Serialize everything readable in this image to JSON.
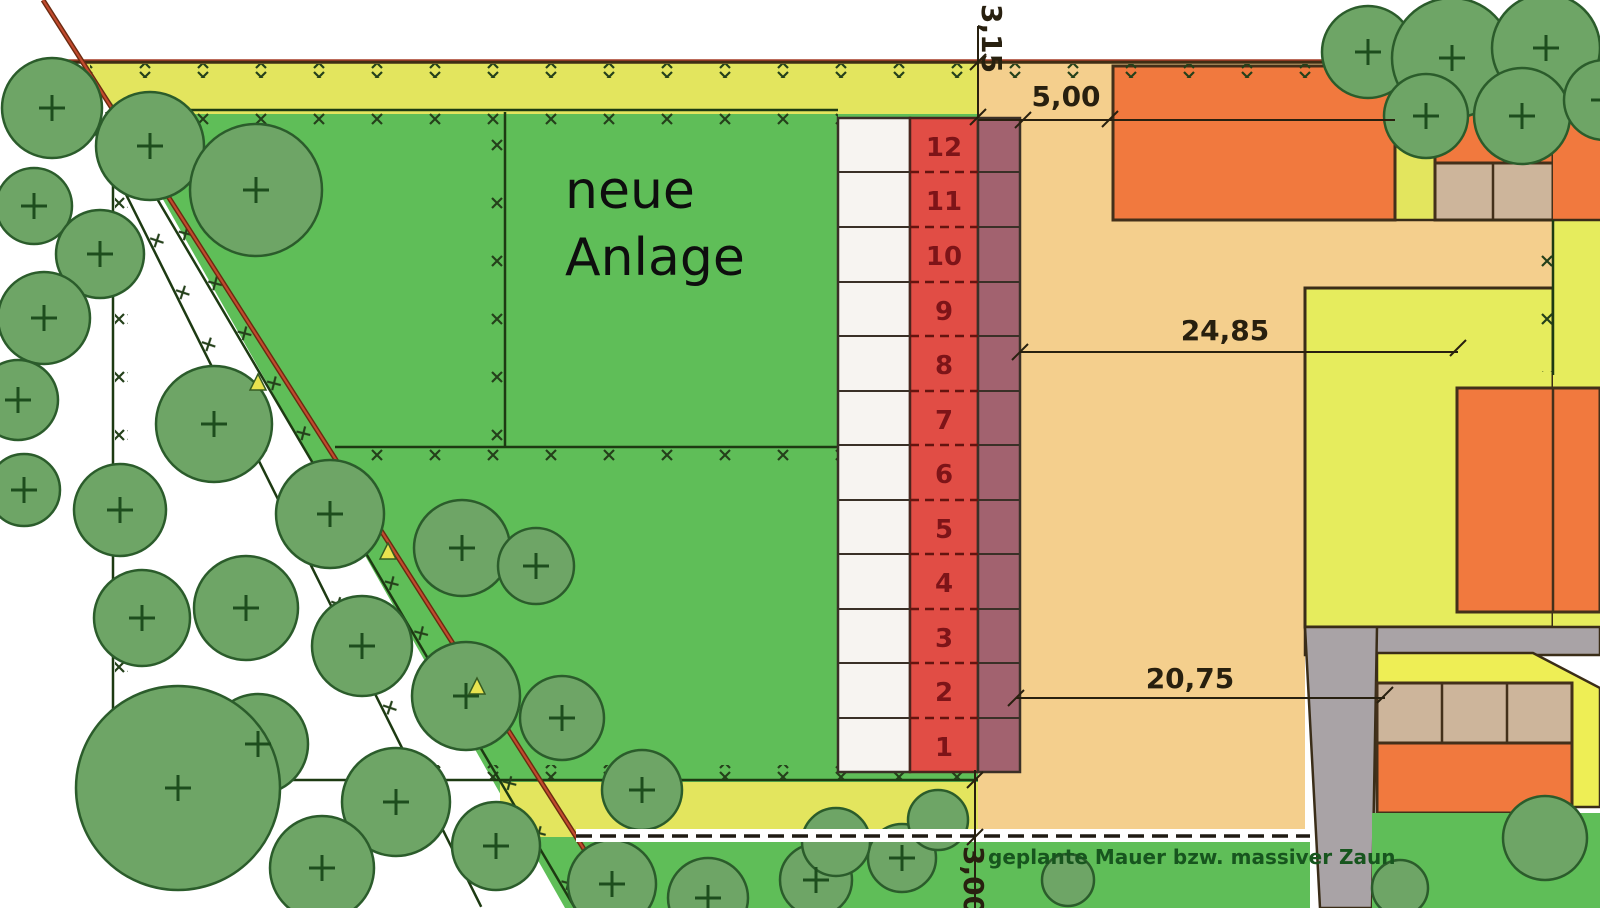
{
  "plan_labels": {
    "area_line1": "neue",
    "area_line2": "Anlage",
    "wall_note": "geplante Mauer bzw. massiver Zaun"
  },
  "dimensions": {
    "strip_top": "3,15",
    "building_gap": "5,00",
    "upper_width": "24,85",
    "lower_width": "20,75",
    "strip_bottom": "3,00"
  },
  "parking_stalls": {
    "numbers": [
      "12",
      "11",
      "10",
      "9",
      "8",
      "7",
      "6",
      "5",
      "4",
      "3",
      "2",
      "1"
    ]
  },
  "colors": {
    "ground_green": "#5fbe58",
    "canopy_green": "#6ea566",
    "strip_yellow_green": "#e3e55e",
    "plot_tan": "#f4cf8d",
    "building_orange": "#f1793e",
    "garage_tan": "#cdb59b",
    "stall_red": "#e14d45",
    "stall_maroon": "#a2626f",
    "stall_white": "#f7f4f1",
    "asphalt_gray": "#a9a3a6",
    "boundary_red": "#b04030",
    "line_dark": "#3a2d18"
  }
}
